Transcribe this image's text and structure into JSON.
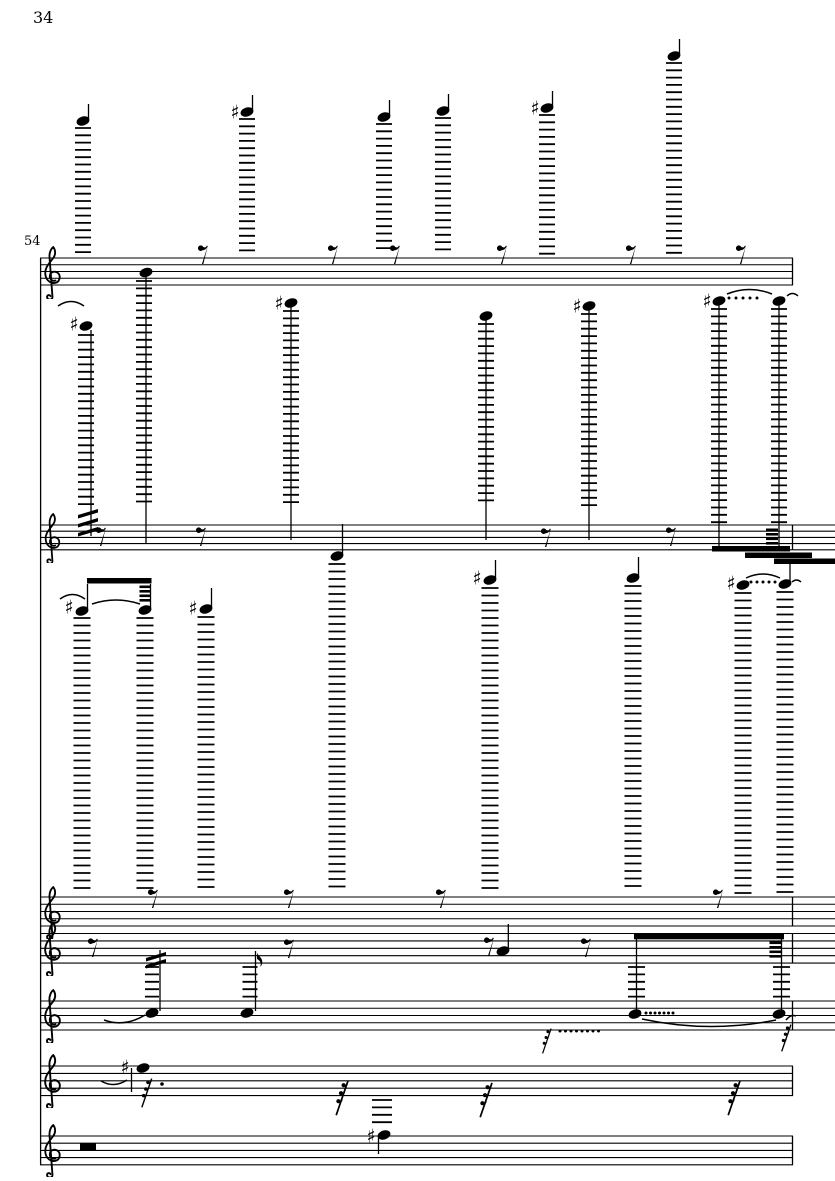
{
  "header": {
    "page_number": "34",
    "measure_number": "54"
  },
  "colors": {
    "ink": "#000000",
    "paper": "#ffffff"
  },
  "score": {
    "description": "Orchestral score page, one system of seven treble staves; notes in extreme registers joined to their staves by long ledger-line ladders",
    "staves": [
      [
        40,
        793,
        258,
        6.75
      ],
      [
        40,
        835,
        525,
        6.2
      ],
      [
        40,
        835,
        897,
        7.25
      ],
      [
        40,
        835,
        933.5,
        7.4
      ],
      [
        40,
        835,
        1001,
        7.25
      ],
      [
        40,
        793,
        1066,
        7.4
      ],
      [
        40,
        793,
        1136,
        7.2
      ]
    ],
    "barlines": [
      [
        40.6,
        258,
        1164.8
      ],
      [
        792.5,
        258,
        285
      ],
      [
        792.5,
        525,
        549.8
      ],
      [
        792.5,
        897,
        926
      ],
      [
        792.5,
        933.5,
        963.1
      ],
      [
        792.5,
        1001,
        1030
      ],
      [
        792.5,
        1066,
        1095.6
      ],
      [
        792.5,
        1136,
        1164.8
      ]
    ],
    "clefs": [
      [
        41,
        246,
        53
      ],
      [
        41,
        513,
        50
      ],
      [
        41,
        886,
        53
      ],
      [
        41,
        922,
        54
      ],
      [
        41,
        989,
        54
      ],
      [
        41,
        1054,
        54
      ],
      [
        41,
        1124,
        53
      ]
    ],
    "ladders": [
      [
        83,
        128,
        255,
        7.3,
        16
      ],
      [
        247,
        119,
        255,
        7.3,
        16
      ],
      [
        384,
        124,
        255,
        7.3,
        16
      ],
      [
        443,
        118,
        255,
        7.3,
        16
      ],
      [
        547,
        115,
        255,
        7.3,
        16
      ],
      [
        674,
        63,
        255,
        7.3,
        16
      ],
      [
        86,
        335,
        507,
        7.35,
        16
      ],
      [
        144,
        281,
        507,
        7.35,
        16
      ],
      [
        291,
        311,
        507,
        7.35,
        16
      ],
      [
        486,
        324,
        507,
        7.35,
        16
      ],
      [
        589,
        314,
        507,
        7.35,
        16
      ],
      [
        719,
        309,
        523,
        7.35,
        16
      ],
      [
        779,
        309,
        523,
        7.35,
        16
      ],
      [
        82,
        618,
        893,
        7.5,
        17
      ],
      [
        145,
        618,
        893,
        7.5,
        17
      ],
      [
        206,
        617,
        893,
        7.5,
        17
      ],
      [
        337,
        564,
        893,
        7.5,
        17
      ],
      [
        490,
        588,
        893,
        7.5,
        17
      ],
      [
        633,
        586,
        893,
        7.5,
        17
      ],
      [
        743,
        593,
        893,
        7.5,
        17
      ],
      [
        785,
        592,
        893,
        7.5,
        17
      ],
      [
        636.5,
        967,
        1000,
        7.4,
        17
      ],
      [
        781.5,
        967,
        1000,
        7.4,
        17
      ],
      [
        152,
        967,
        998,
        7.4,
        14
      ],
      [
        250,
        967,
        998,
        7.4,
        15
      ],
      [
        382,
        1100,
        1124,
        7.4,
        20
      ]
    ],
    "heads": [
      [
        83,
        121
      ],
      [
        247,
        112
      ],
      [
        384,
        117
      ],
      [
        443,
        111
      ],
      [
        547,
        108
      ],
      [
        674,
        56
      ],
      [
        146,
        272.5
      ],
      [
        86,
        326
      ],
      [
        291,
        303
      ],
      [
        486,
        316
      ],
      [
        589,
        306
      ],
      [
        719,
        301
      ],
      [
        779,
        301
      ],
      [
        82,
        611
      ],
      [
        145,
        610
      ],
      [
        206,
        609
      ],
      [
        337,
        556
      ],
      [
        490,
        580
      ],
      [
        633,
        578
      ],
      [
        743,
        585
      ],
      [
        785,
        584
      ],
      [
        503,
        951
      ],
      [
        635,
        1014
      ],
      [
        779,
        1014
      ],
      [
        152,
        1013
      ],
      [
        247,
        1013
      ],
      [
        143,
        1068
      ],
      [
        384,
        1135
      ]
    ],
    "stems": [
      [
        88.5,
        104,
        119
      ],
      [
        252.5,
        95,
        110
      ],
      [
        389.5,
        100,
        115
      ],
      [
        448.5,
        94,
        109
      ],
      [
        552.5,
        91,
        106
      ],
      [
        679.5,
        39,
        54
      ],
      [
        146,
        277,
        544
      ],
      [
        91,
        330,
        536
      ],
      [
        291,
        307,
        540
      ],
      [
        486,
        320,
        540
      ],
      [
        589,
        310,
        540
      ],
      [
        719,
        305,
        547
      ],
      [
        779,
        305,
        547
      ],
      [
        87.5,
        584,
        609
      ],
      [
        150.5,
        584,
        608
      ],
      [
        211.5,
        588,
        607
      ],
      [
        342.5,
        524,
        554
      ],
      [
        495.5,
        560,
        578
      ],
      [
        638.5,
        557,
        576
      ],
      [
        790,
        564,
        582
      ],
      [
        508.3,
        924,
        949
      ],
      [
        636.5,
        939,
        1012
      ],
      [
        781.5,
        939,
        1012
      ],
      [
        160,
        950,
        1011
      ],
      [
        255.5,
        951,
        1011
      ],
      [
        131.5,
        1068,
        1092
      ],
      [
        378.5,
        1136,
        1154
      ]
    ],
    "sharps": [
      [
        235,
        112
      ],
      [
        535,
        108
      ],
      [
        74,
        324
      ],
      [
        279,
        303
      ],
      [
        577,
        306
      ],
      [
        707,
        301
      ],
      [
        69,
        607
      ],
      [
        193,
        608
      ],
      [
        477,
        578
      ],
      [
        731,
        583
      ],
      [
        125,
        1067
      ],
      [
        371,
        1136
      ]
    ],
    "eighth_rests": [
      [
        198,
        245
      ],
      [
        328,
        245
      ],
      [
        390,
        245
      ],
      [
        497,
        245
      ],
      [
        626,
        245
      ],
      [
        736,
        245
      ],
      [
        96,
        527
      ],
      [
        196,
        527
      ],
      [
        541,
        528
      ],
      [
        666,
        527
      ],
      [
        148,
        889
      ],
      [
        284,
        889
      ],
      [
        436,
        889
      ],
      [
        713,
        889
      ],
      [
        88,
        938
      ],
      [
        284,
        939
      ],
      [
        484,
        937
      ],
      [
        581,
        938
      ]
    ],
    "flags": [
      [
        256,
        951
      ]
    ],
    "beams": [
      [
        712,
        546,
        78,
        5.5
      ],
      [
        745,
        552.5,
        67,
        5.5
      ],
      [
        774,
        558.5,
        61,
        5.5
      ],
      [
        87,
        578,
        64.5,
        5.5
      ],
      [
        634,
        933.5,
        150,
        5.8
      ]
    ],
    "beamlets": [
      [
        766,
        528.5,
        12
      ],
      [
        766,
        533,
        12
      ],
      [
        766,
        537.5,
        12
      ],
      [
        766,
        542,
        12
      ],
      [
        139.5,
        585.5,
        11.5
      ],
      [
        139.5,
        590,
        11.5
      ],
      [
        139.5,
        594.5,
        11.5
      ],
      [
        139.5,
        599,
        11.5
      ],
      [
        769.5,
        941.5,
        12
      ],
      [
        769.5,
        946,
        12
      ],
      [
        769.5,
        950.5,
        12
      ],
      [
        769.5,
        955,
        12
      ]
    ],
    "tremolos": [
      [
        78,
        508
      ],
      [
        78,
        517
      ],
      [
        78,
        526
      ],
      [
        146,
        951
      ],
      [
        146,
        958
      ]
    ],
    "dotted_lines": [
      [
        729,
        298,
        5,
        7
      ],
      [
        751,
        582,
        5,
        6
      ],
      [
        646,
        1013,
        7,
        4.5
      ],
      [
        560,
        1031,
        8,
        5.5
      ]
    ],
    "aug_dots": [
      [
        162,
        1084
      ]
    ],
    "ties": [
      [
        58,
        306,
        84,
        306,
        -9
      ],
      [
        727,
        294,
        772,
        294,
        -9
      ],
      [
        787,
        296,
        798,
        296,
        -5
      ],
      [
        60,
        599,
        85,
        599,
        -9
      ],
      [
        92,
        604,
        140,
        604,
        -8
      ],
      [
        746,
        578,
        780,
        578,
        -8
      ],
      [
        792,
        582,
        801,
        582,
        -4
      ],
      [
        642,
        1019,
        776,
        1020,
        14
      ],
      [
        104,
        1020,
        145,
        1015,
        10
      ],
      [
        786,
        1020,
        796,
        1016,
        -4
      ],
      [
        101,
        1081,
        127,
        1080,
        8
      ]
    ],
    "grace_rests": [
      [
        541,
        1028,
        26
      ],
      [
        780,
        1024,
        28
      ],
      [
        140,
        1078,
        30
      ],
      [
        334,
        1080,
        36
      ],
      [
        478,
        1082,
        36
      ],
      [
        726,
        1080,
        36
      ]
    ],
    "half_rests": [
      [
        80,
        1143.5,
        16,
        6.5
      ]
    ]
  }
}
